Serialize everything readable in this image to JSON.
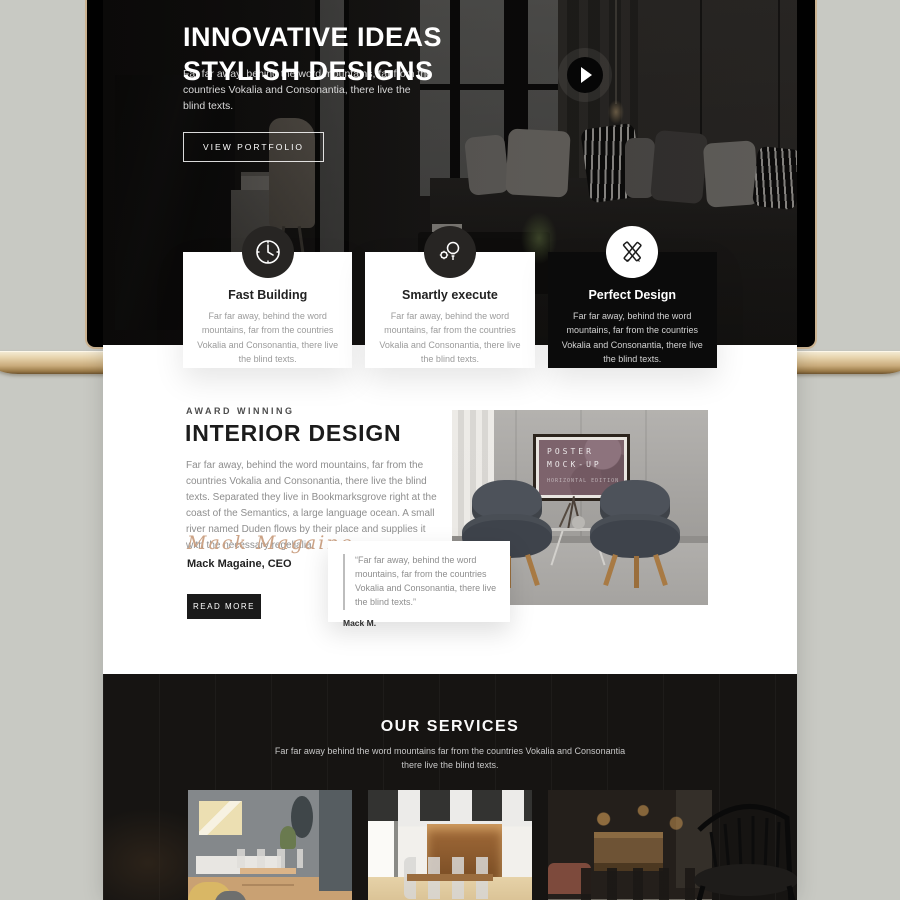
{
  "hero": {
    "title_line1": "INNOVATIVE IDEAS",
    "title_line2": "STYLISH DESIGNS",
    "subtitle": "Far far away, behind the word mountains, far from the countries Vokalia and Consonantia, there live the blind texts.",
    "cta": "VIEW PORTFOLIO"
  },
  "features": [
    {
      "icon": "clock-icon",
      "title": "Fast Building",
      "text": "Far far away, behind the word mountains, far from the countries Vokalia and Consonantia, there live the blind texts."
    },
    {
      "icon": "idea-gears-icon",
      "title": "Smartly execute",
      "text": "Far far away, behind the word mountains, far from the countries Vokalia and Consonantia, there live the blind texts."
    },
    {
      "icon": "pencil-ruler-icon",
      "title": "Perfect Design",
      "text": "Far far away, behind the word mountains, far from the countries Vokalia and Consonantia, there live the blind texts."
    }
  ],
  "about": {
    "eyebrow": "AWARD WINNING",
    "title": "INTERIOR DESIGN",
    "body": "Far far away, behind the word mountains, far from the countries Vokalia and Consonantia, there live the blind texts. Separated they live in Bookmarksgrove right at the coast of the Semantics, a large language ocean. A small river named Duden flows by their place and supplies it with the necessary regelialia.",
    "signature": "Mack Magaine",
    "author": "Mack Magaine, CEO",
    "cta": "READ MORE",
    "quote": {
      "text": "“Far far away, behind the word mountains, far from the countries Vokalia and Consonantia, there live the blind texts.”",
      "author": "Mack M."
    },
    "poster": {
      "line1": "POSTER",
      "line2": "MOCK-UP",
      "edition": "HORIZONTAL EDITION"
    }
  },
  "services": {
    "title": "OUR SERVICES",
    "subtitle": "Far far away behind the word mountains far from the countries Vokalia and Consonantia there live the blind texts.",
    "items": [
      {
        "name": "dining-room-photo"
      },
      {
        "name": "conference-room-photo"
      },
      {
        "name": "restaurant-photo"
      }
    ]
  },
  "colors": {
    "background": "#c8c9c3",
    "laptop_gold": "#cdb492",
    "accent_signature": "#cca386",
    "dark_section": "#161412",
    "dark_card": "#0b0b0b"
  }
}
